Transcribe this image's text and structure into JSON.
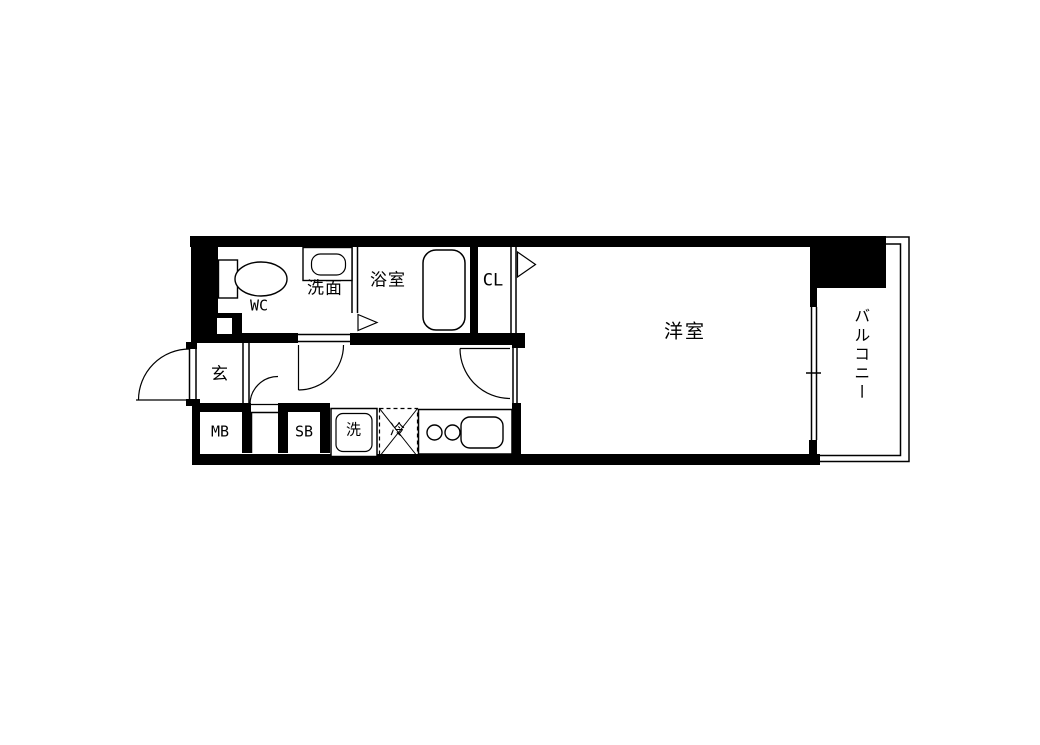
{
  "plan": {
    "rooms": {
      "wc": "WC",
      "washroom": "洗面",
      "bathroom": "浴室",
      "closet": "CL",
      "entrance": "玄",
      "meter_box": "MB",
      "shoe_box": "SB",
      "washer": "洗",
      "refrigerator": "冷",
      "western_room": "洋室",
      "balcony": "バルコニー"
    },
    "icons": {
      "toilet": "toilet-icon",
      "washbasin": "washbasin-icon",
      "bathtub": "bathtub-icon",
      "stove_burners": "stove-burners-icon",
      "kitchen_sink": "kitchen-sink-icon",
      "washing_machine_pan": "washing-machine-pan-icon",
      "refrigerator_space": "refrigerator-space-icon",
      "door_swing": "door-swing-icon",
      "window": "window-icon",
      "opening_marker": "opening-triangle-icon"
    },
    "colors": {
      "wall": "#000000",
      "background": "#ffffff",
      "line": "#000000"
    }
  }
}
